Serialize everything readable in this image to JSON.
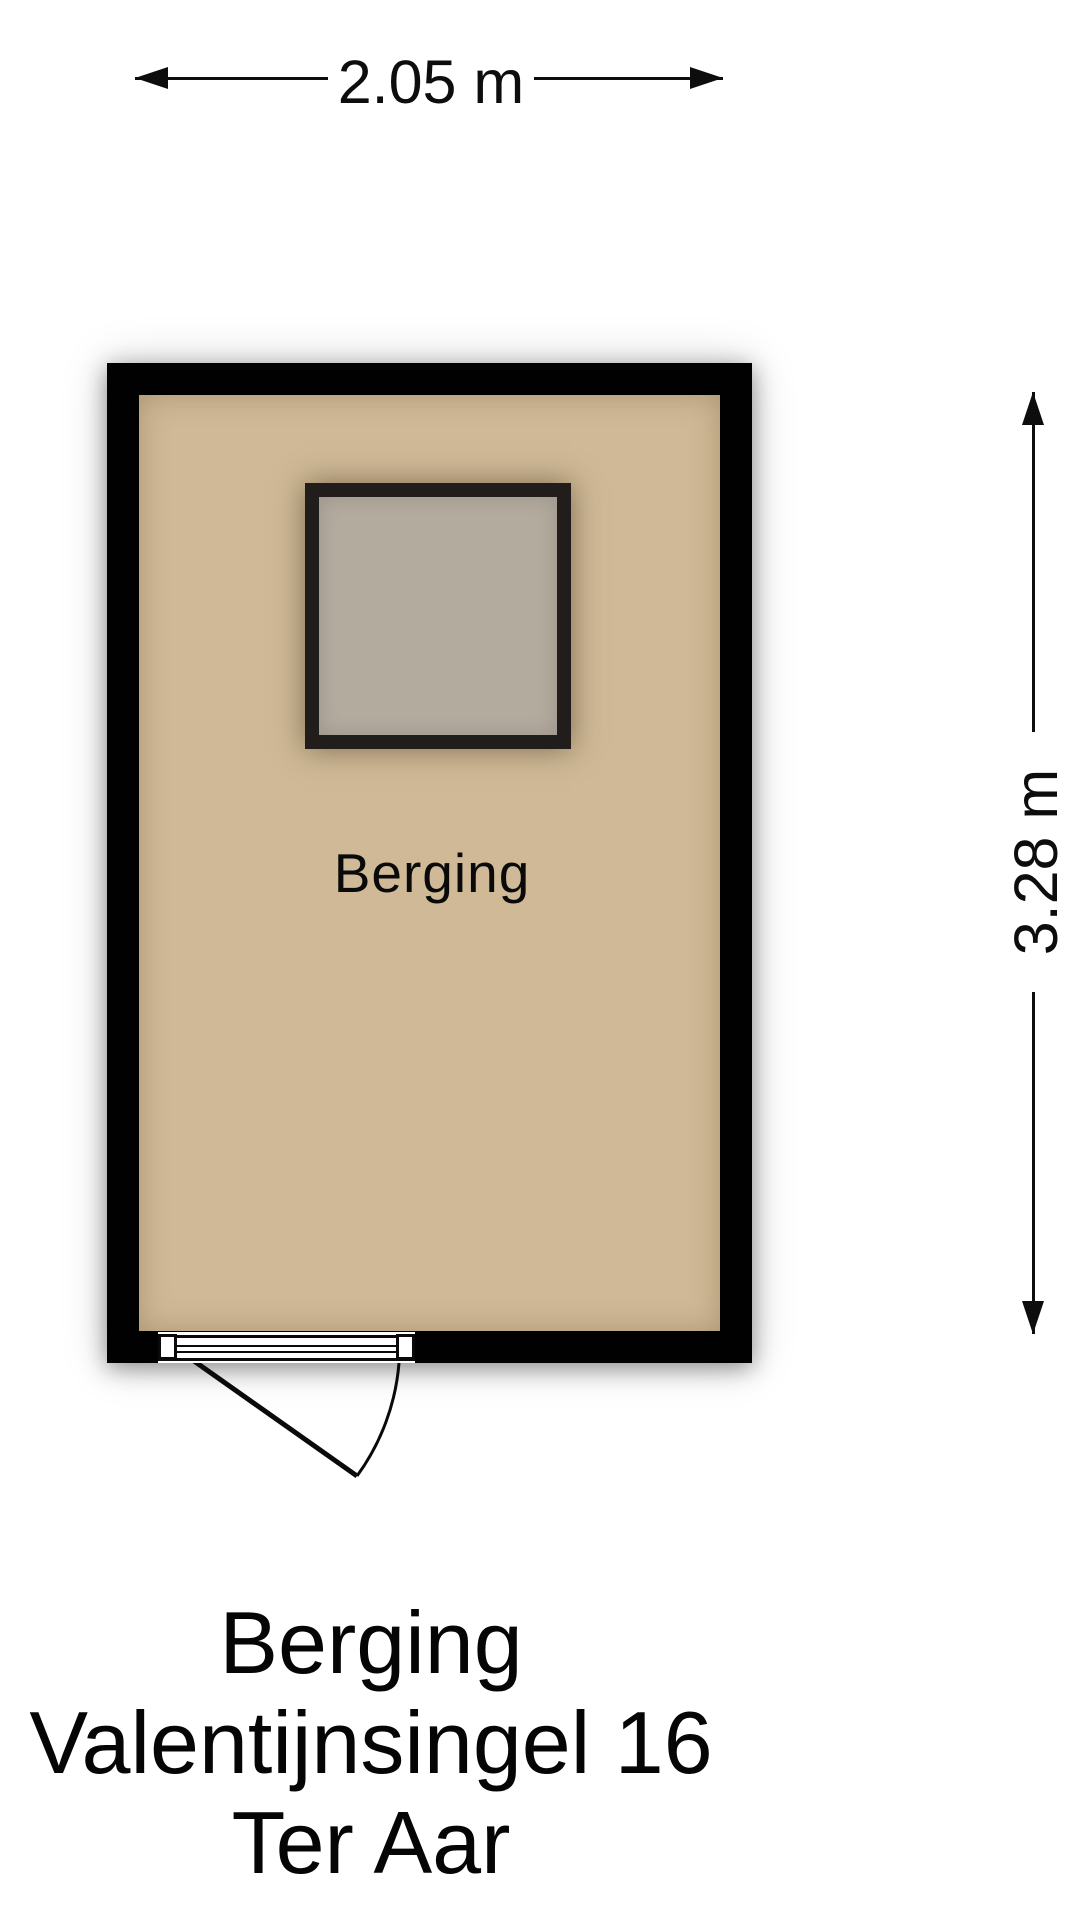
{
  "dimensions": {
    "width_label": "2.05 m",
    "height_label": "3.28 m"
  },
  "room": {
    "label": "Berging",
    "floor_color": "#cfb996",
    "wall_color": "#010101",
    "skylight_fill": "#b4ab9f"
  },
  "title": {
    "line1": "Berging",
    "line2": "Valentijnsingel 16",
    "line3": "Ter Aar"
  }
}
